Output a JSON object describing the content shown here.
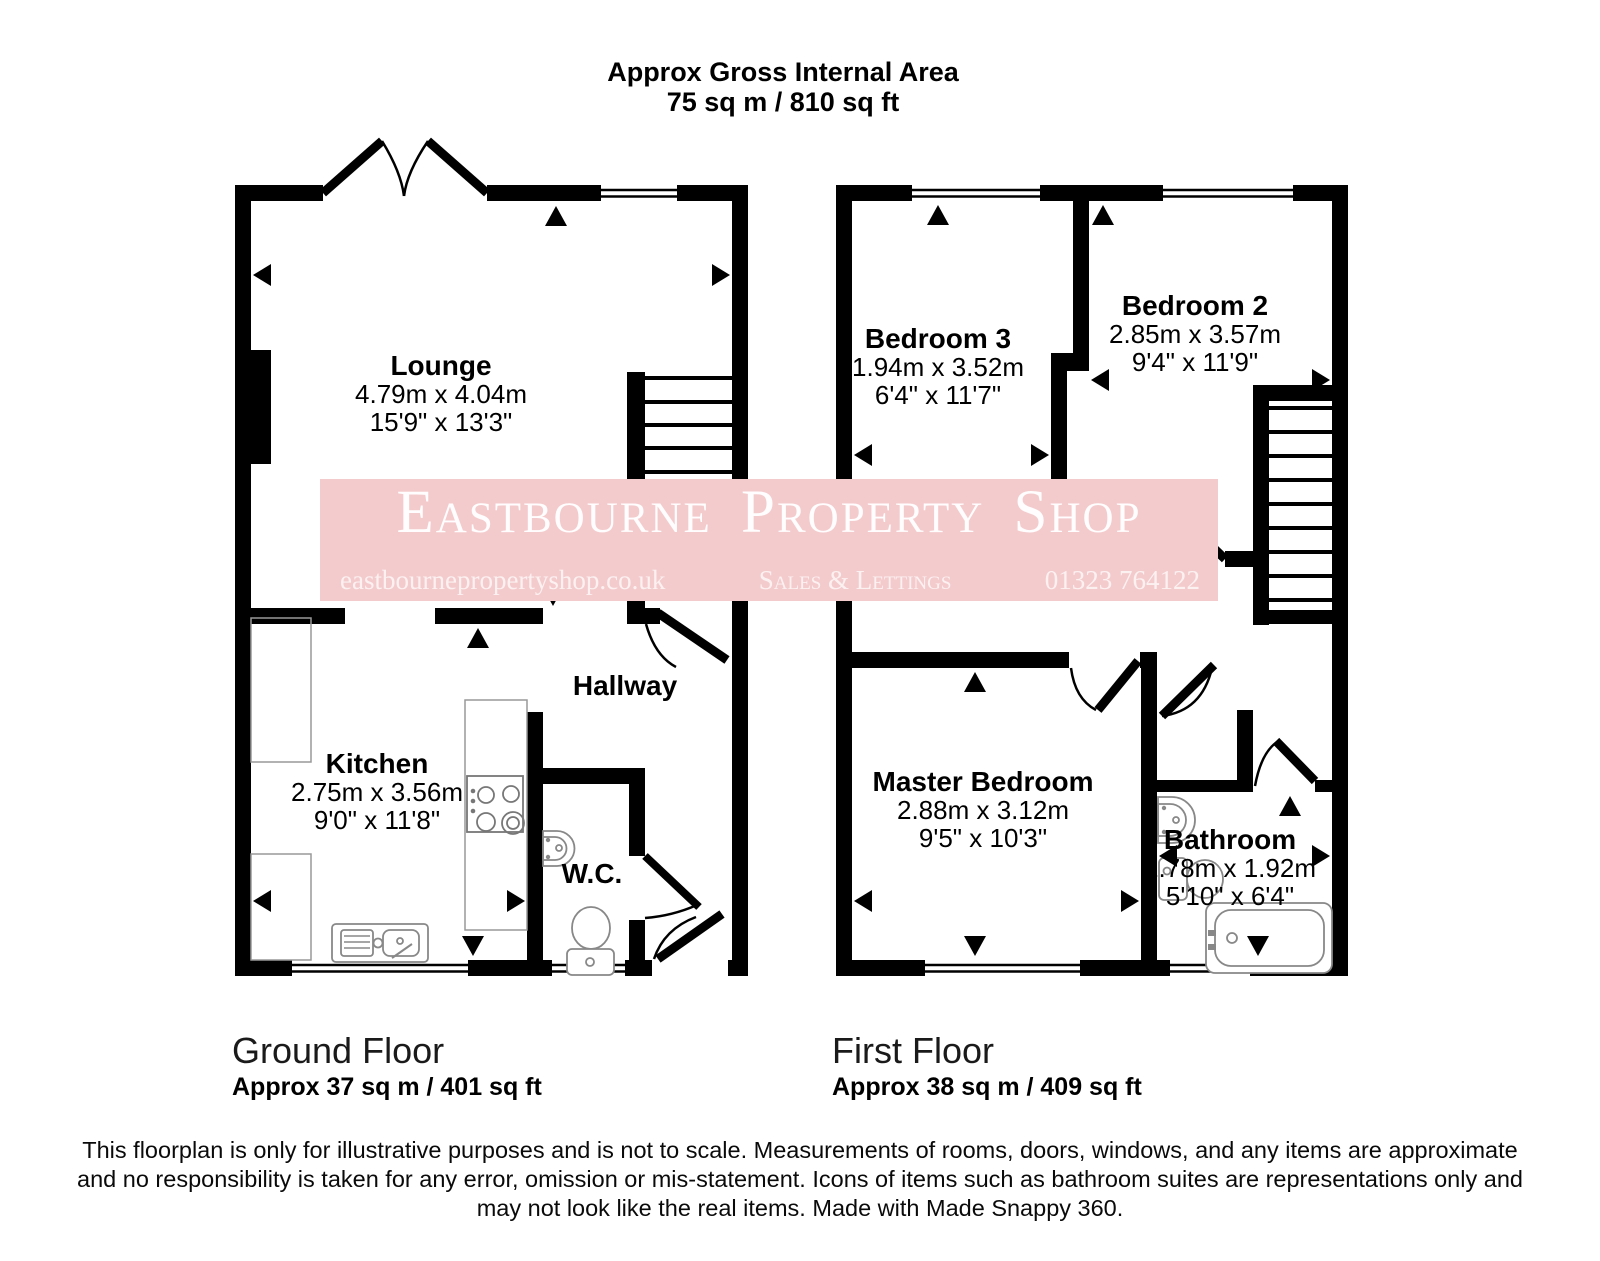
{
  "header": {
    "title": "Approx Gross Internal Area",
    "area": "75 sq m / 810 sq ft"
  },
  "watermark": {
    "title": "Eastbourne Property Shop",
    "website": "eastbournepropertyshop.co.uk",
    "tagline": "Sales & Lettings",
    "phone": "01323 764122",
    "pink": "#f4cbcd"
  },
  "rooms": {
    "lounge": {
      "name": "Lounge",
      "metric": "4.79m x 4.04m",
      "imperial": "15'9\" x 13'3\""
    },
    "kitchen": {
      "name": "Kitchen",
      "metric": "2.75m x 3.56m",
      "imperial": "9'0\" x 11'8\""
    },
    "hallway": {
      "name": "Hallway"
    },
    "wc": {
      "name": "W.C."
    },
    "bedroom3": {
      "name": "Bedroom 3",
      "metric": "1.94m x 3.52m",
      "imperial": "6'4\" x 11'7\""
    },
    "bedroom2": {
      "name": "Bedroom 2",
      "metric": "2.85m x 3.57m",
      "imperial": "9'4\" x 11'9\""
    },
    "master": {
      "name": "Master Bedroom",
      "metric": "2.88m x 3.12m",
      "imperial": "9'5\" x 10'3\""
    },
    "bathroom": {
      "name": "Bathroom",
      "metric": "1.78m x 1.92m",
      "imperial": "5'10\" x 6'4\""
    }
  },
  "floors": {
    "ground": {
      "title": "Ground Floor",
      "area": "Approx 37 sq m / 401 sq ft"
    },
    "first": {
      "title": "First Floor",
      "area": "Approx 38 sq m / 409 sq ft"
    }
  },
  "disclaimer": {
    "line1": "This floorplan is only for illustrative purposes and is not to scale. Measurements of rooms, doors, windows, and any items are approximate",
    "line2": "and no responsibility is taken for any error, omission or mis-statement. Icons of items such as bathroom suites are representations only and",
    "line3": "may not look like the real items. Made with Made Snappy 360."
  },
  "colors": {
    "wall": "#000000",
    "fixture_outline": "#8a8a8a"
  }
}
